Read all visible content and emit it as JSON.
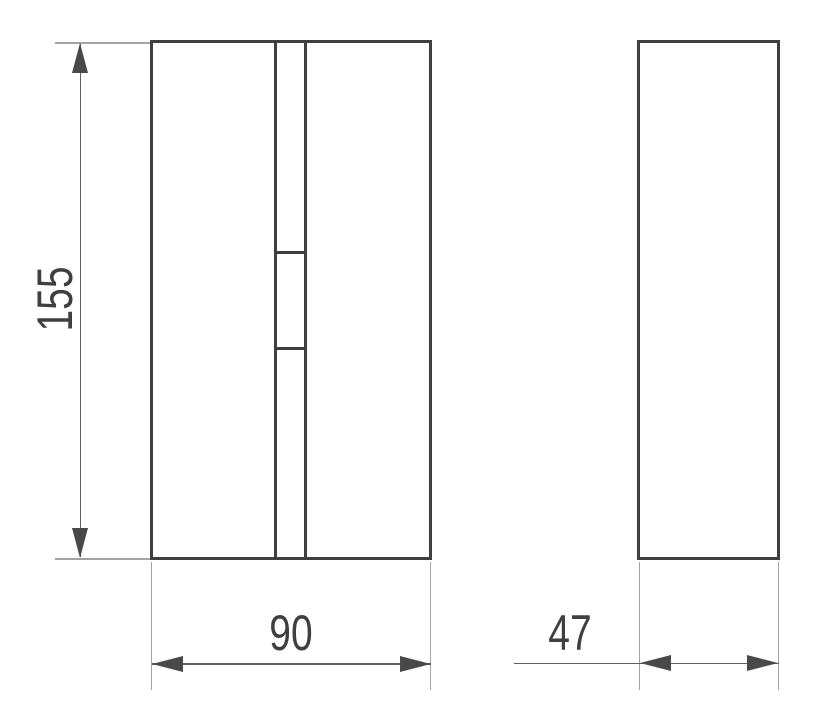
{
  "drawing": {
    "background": "#ffffff",
    "palette": {
      "object_line": "#3f3f3f",
      "dimension_line": "#5f5f5f",
      "extension_line": "#a3a3a3",
      "arrowhead": "#494949",
      "text": "#3f3f3f"
    },
    "dimensions": {
      "height": {
        "value": "155"
      },
      "width": {
        "value": "90"
      },
      "depth": {
        "value": "47"
      }
    }
  }
}
